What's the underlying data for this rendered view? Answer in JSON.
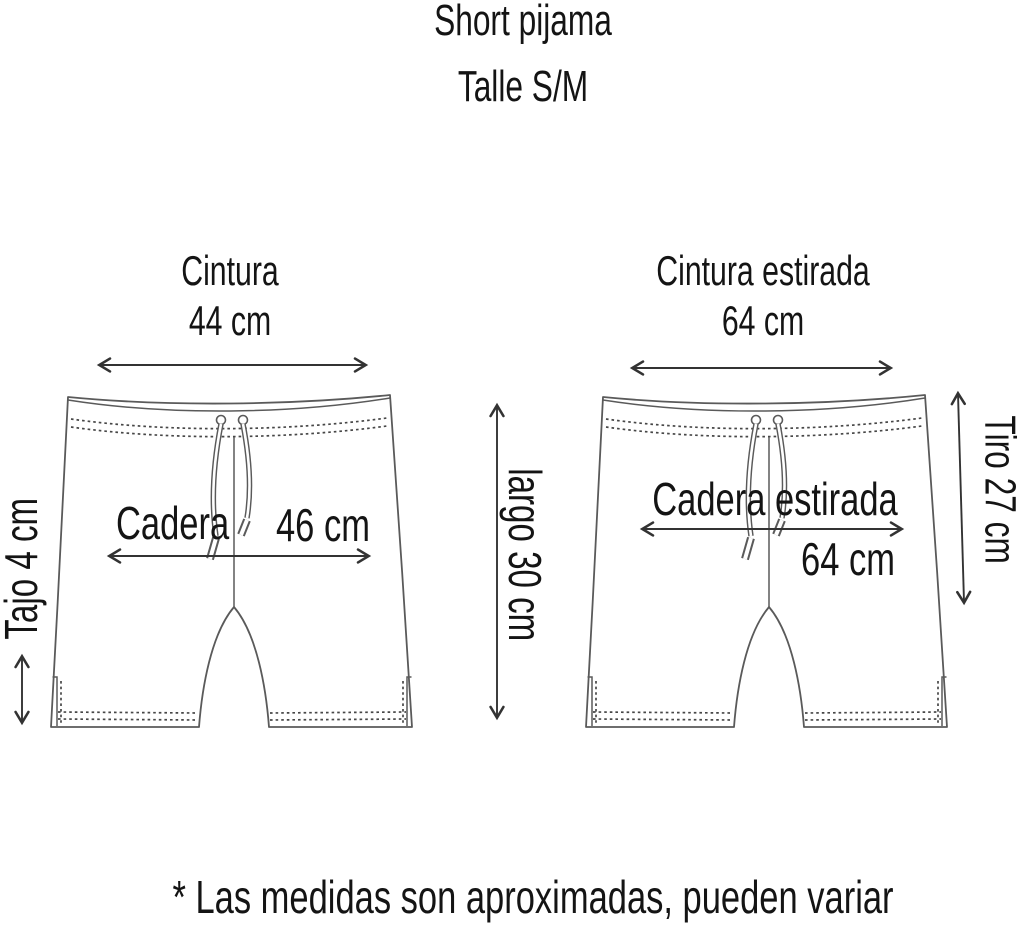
{
  "title": "Short pijama",
  "size_label": "Talle S/M",
  "left_short": {
    "waist": {
      "label": "Cintura",
      "value": "44 cm"
    },
    "hip": {
      "label": "Cadera",
      "value": "46 cm"
    },
    "slit": {
      "label": "Tajo 4 cm"
    }
  },
  "right_short": {
    "waist": {
      "label": "Cintura estirada",
      "value": "64 cm"
    },
    "hip": {
      "label": "Cadera estirada",
      "value": "64 cm"
    },
    "rise": {
      "label": "Tiro 27 cm"
    }
  },
  "length": {
    "label": "largo 30 cm"
  },
  "footnote": "* Las medidas son aproximadas, pueden variar",
  "colors": {
    "background": "#ffffff",
    "drawing_line": "#5a5a5a",
    "arrow": "#333333",
    "text": "#141414"
  }
}
